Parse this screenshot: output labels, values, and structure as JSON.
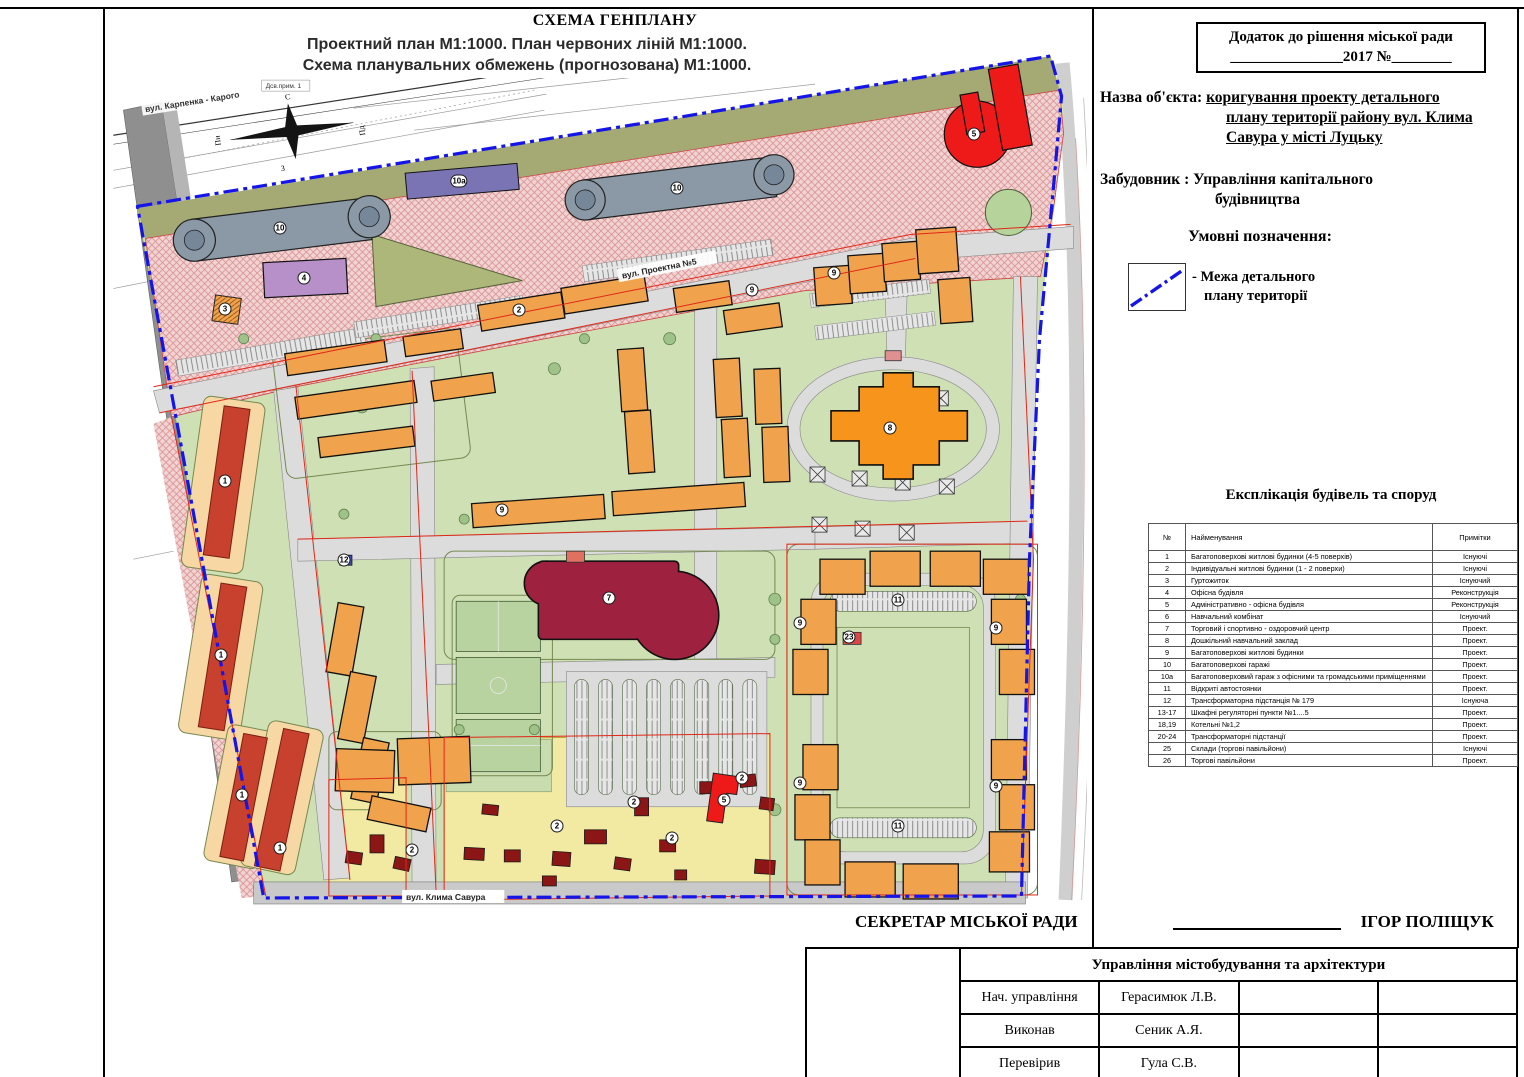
{
  "header": {
    "scheme_title": "СХЕМА ГЕНПЛАНУ",
    "subtitle_line1": "Проектний план  М1:1000. План червоних ліній   М1:1000.",
    "subtitle_line2": "Схема планувальних обмежень  (прогнозована)  М1:1000."
  },
  "decision_box": {
    "line1": "Додаток до рішення міської ради",
    "line2": "_______________2017  №________"
  },
  "object": {
    "label": "Назва об'єкта:",
    "value_line1": "коригування проекту детального",
    "value_line2": "плану території району вул. Клима",
    "value_line3": "Савура у місті Луцьку"
  },
  "developer": {
    "label": "Забудовник :",
    "value_line1": "Управління капітального",
    "value_line2": "будівництва"
  },
  "legend": {
    "title": "Умовні позначення:",
    "item1_line1": "-  Межа детального",
    "item1_line2": "плану території"
  },
  "explication": {
    "title": "Експлікація будівель та споруд",
    "columns": [
      "№",
      "Найменування",
      "Примітки"
    ],
    "rows": [
      [
        "1",
        "Багатоповерхові житлові будинки (4-5 поверхів)",
        "Існуючі"
      ],
      [
        "2",
        "Індивідуальні житлові будинки (1 - 2 поверхи)",
        "Існуючі"
      ],
      [
        "3",
        "Гуртожиток",
        "Існуючий"
      ],
      [
        "4",
        "Офісна будівля",
        "Реконструкція"
      ],
      [
        "5",
        "Адміністративно - офісна будівля",
        "Реконструкція"
      ],
      [
        "6",
        "Навчальний комбінат",
        "Існуючий"
      ],
      [
        "7",
        "Торговий і спортивно - оздоровчий центр",
        "Проект."
      ],
      [
        "8",
        "Дошкільний навчальний заклад",
        "Проект."
      ],
      [
        "9",
        "Багатоповерхові житлові будинки",
        "Проект."
      ],
      [
        "10",
        "Багатоповерхові гаражі",
        "Проект."
      ],
      [
        "10а",
        "Багатоповерховий гараж з офісними та громадськими приміщеннями",
        "Проект."
      ],
      [
        "11",
        "Відкриті автостоянки",
        "Проект."
      ],
      [
        "12",
        "Трансформаторна підстанція № 179",
        "Існуюча"
      ],
      [
        "13-17",
        "Шкафні регуляторні пункти №1....5",
        "Проект."
      ],
      [
        "18,19",
        "Котельні №1,2",
        "Проект."
      ],
      [
        "20-24",
        "Трансформаторні підстанції",
        "Проект."
      ],
      [
        "25",
        "Склади (торгові павільйони)",
        "Існуючі"
      ],
      [
        "26",
        "Торгові павільйони",
        "Проект."
      ]
    ]
  },
  "secretary": {
    "label": "СЕКРЕТАР МІСЬКОЇ РАДИ",
    "name": "ІГОР ПОЛІЩУК"
  },
  "approval_table": {
    "department": "Управління містобудування та архітектури",
    "rows": [
      {
        "role": "Нач. управління",
        "name": "Герасимюк Л.В."
      },
      {
        "role": "Виконав",
        "name": "Сеник А.Я."
      },
      {
        "role": "Перевірив",
        "name": "Гула С.В."
      }
    ]
  },
  "map": {
    "streets": {
      "karpenka": "вул. Карпенка - Карого",
      "proektna": "вул. Проектна №5",
      "savura": "вул. Клима Савура"
    },
    "note": "Дсв.прим. 1",
    "compass": {
      "n": "Пн",
      "s": "Пд",
      "e": "С",
      "w": "З"
    },
    "markers": [
      {
        "n": "10",
        "x": 168,
        "y": 190
      },
      {
        "n": "10",
        "x": 565,
        "y": 150
      },
      {
        "n": "10а",
        "x": 347,
        "y": 143
      },
      {
        "n": "4",
        "x": 192,
        "y": 240
      },
      {
        "n": "5",
        "x": 862,
        "y": 96
      },
      {
        "n": "3",
        "x": 113,
        "y": 271
      },
      {
        "n": "1",
        "x": 113,
        "y": 443
      },
      {
        "n": "1",
        "x": 109,
        "y": 617
      },
      {
        "n": "1",
        "x": 130,
        "y": 757
      },
      {
        "n": "1",
        "x": 168,
        "y": 810
      },
      {
        "n": "12",
        "x": 232,
        "y": 522
      },
      {
        "n": "2",
        "x": 407,
        "y": 272
      },
      {
        "n": "9",
        "x": 640,
        "y": 252
      },
      {
        "n": "9",
        "x": 722,
        "y": 235
      },
      {
        "n": "9",
        "x": 390,
        "y": 472
      },
      {
        "n": "8",
        "x": 778,
        "y": 390
      },
      {
        "n": "7",
        "x": 497,
        "y": 560
      },
      {
        "n": "9",
        "x": 688,
        "y": 585
      },
      {
        "n": "9",
        "x": 884,
        "y": 590
      },
      {
        "n": "9",
        "x": 688,
        "y": 745
      },
      {
        "n": "9",
        "x": 884,
        "y": 748
      },
      {
        "n": "11",
        "x": 786,
        "y": 562
      },
      {
        "n": "11",
        "x": 786,
        "y": 788
      },
      {
        "n": "23",
        "x": 737,
        "y": 599
      },
      {
        "n": "2",
        "x": 300,
        "y": 812
      },
      {
        "n": "2",
        "x": 445,
        "y": 788
      },
      {
        "n": "2",
        "x": 522,
        "y": 764
      },
      {
        "n": "2",
        "x": 560,
        "y": 800
      },
      {
        "n": "2",
        "x": 630,
        "y": 740
      },
      {
        "n": "5",
        "x": 612,
        "y": 762
      }
    ]
  },
  "colors": {
    "boundary_blue": "#1515e8",
    "red_line": "#e02818",
    "pink_zone": "#f0d4d4",
    "green_zone": "#cfe0b5",
    "yellow_zone": "#f2e9a2",
    "orange_building": "#f0a34c",
    "red_building": "#c8402e",
    "maroon_building": "#9e2140",
    "bright_red_building": "#ee1a1a",
    "garage_gray": "#8b99a6",
    "purple_building": "#b78fc9"
  }
}
